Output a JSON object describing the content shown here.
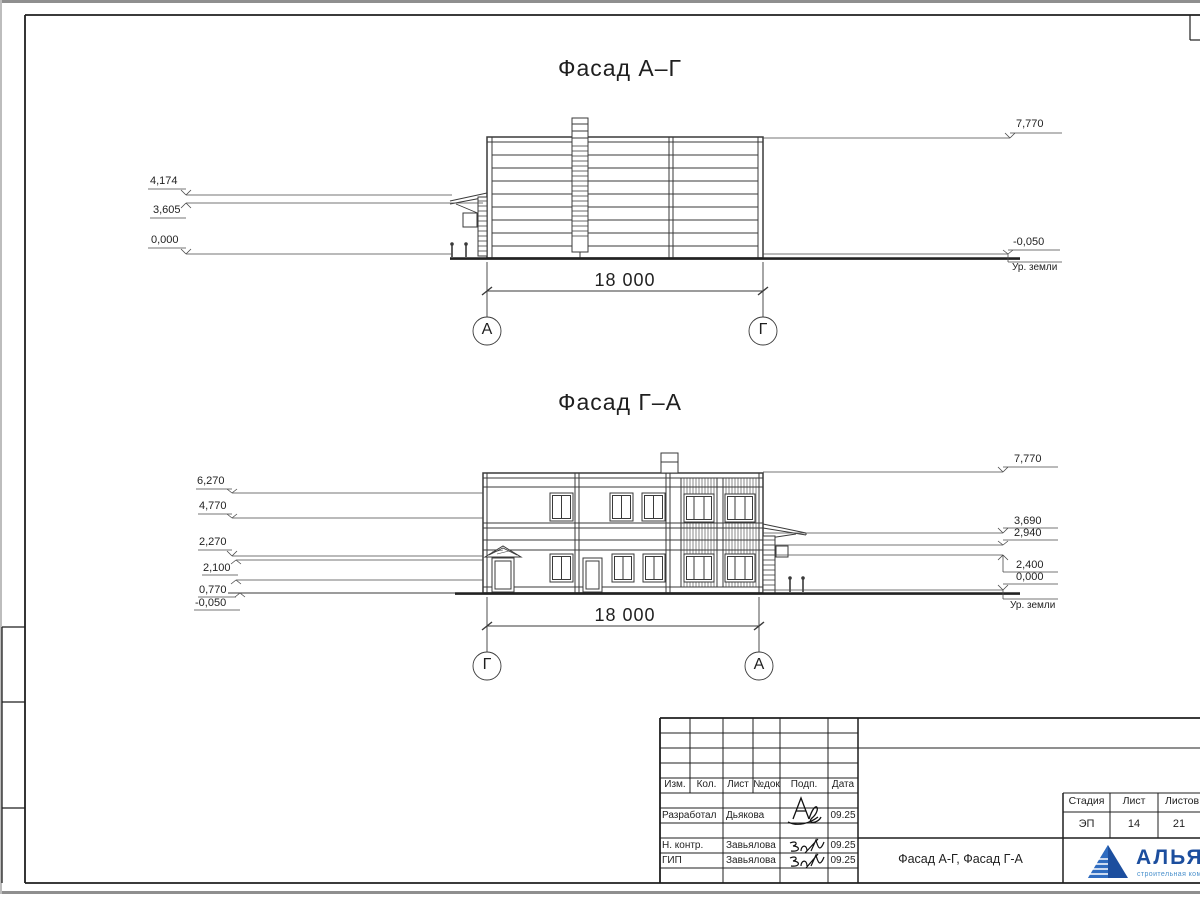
{
  "colors": {
    "accent": "#1c4e9e",
    "light": "#4a90cc",
    "line": "#3a3a3a"
  },
  "facade1": {
    "title": "Фасад А–Г",
    "dim": "18 000",
    "axis_left": "А",
    "axis_right": "Г",
    "marks_left": [
      "4,174",
      "3,605",
      "0,000"
    ],
    "marks_right": [
      "7,770",
      "-0,050"
    ],
    "ground_label": "Ур. земли"
  },
  "facade2": {
    "title": "Фасад Г–А",
    "dim": "18 000",
    "axis_left": "Г",
    "axis_right": "А",
    "marks_left": [
      "6,270",
      "4,770",
      "2,270",
      "2,100",
      "0,770",
      "-0,050"
    ],
    "marks_right": [
      "7,770",
      "3,690",
      "2,940",
      "2,400",
      "0,000"
    ],
    "ground_label": "Ур. земли"
  },
  "titleblock": {
    "columns": [
      "Изм.",
      "Кол.",
      "Лист",
      "№док",
      "Подп.",
      "Дата"
    ],
    "signers": [
      {
        "role": "Разработал",
        "name": "Дьякова",
        "date": "09.25"
      },
      {
        "role": "Н. контр.",
        "name": "Завьялова",
        "date": "09.25"
      },
      {
        "role": "ГИП",
        "name": "Завьялова",
        "date": "09.25"
      }
    ],
    "doc_title": "Фасад А-Г, Фасад Г-А",
    "stage_columns": [
      "Стадия",
      "Лист",
      "Листов"
    ],
    "stage_values": [
      "ЭП",
      "14",
      "21"
    ],
    "logo": {
      "title": "АЛЬЯНС",
      "subtitle": "строительная компания"
    }
  }
}
